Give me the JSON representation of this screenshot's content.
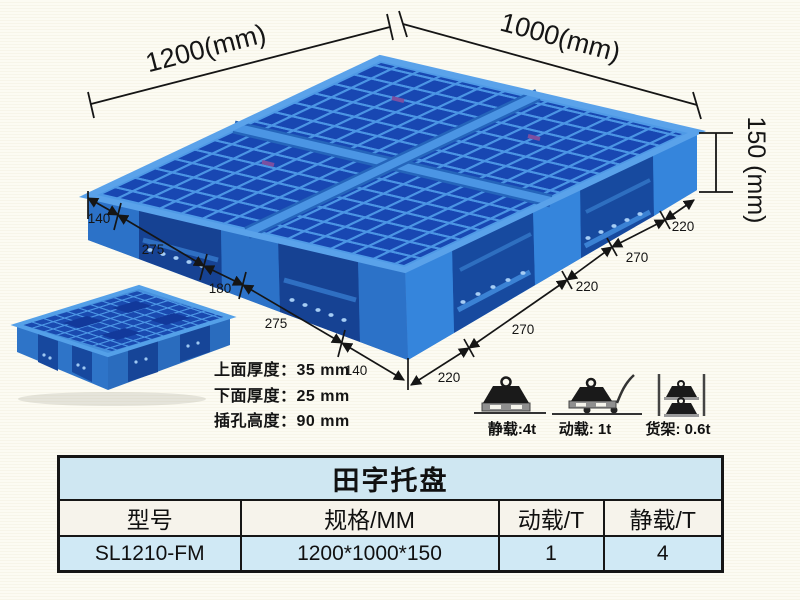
{
  "illustration": {
    "main_pallet": {
      "length_label": "1200(mm)",
      "width_label": "1000(mm)",
      "height_label": "150 (mm)",
      "bottom_left_segments": [
        "140",
        "275",
        "180",
        "275",
        "140"
      ],
      "bottom_right_segments": [
        "220",
        "270",
        "220",
        "270",
        "220"
      ]
    },
    "thickness_notes": {
      "top": "上面厚度：35 mm",
      "bottom": "下面厚度：25 mm",
      "fork_hole": "插孔高度：90 mm"
    },
    "load_ratings": {
      "static": "静载:4t",
      "dynamic": "动载: 1t",
      "rack": "货架: 0.6t"
    }
  },
  "spec_table": {
    "title": "田字托盘",
    "columns": [
      "型号",
      "规格/MM",
      "动载/T",
      "静载/T"
    ],
    "row": {
      "model": "SL1210-FM",
      "size": "1200*1000*150",
      "dynamic_load": "1",
      "static_load": "4"
    }
  },
  "colors": {
    "pallet_blue": "#2f7fd6",
    "pallet_dark_blue": "#1847b2",
    "pallet_light_blue": "#4b95e4",
    "background_cream": "#fbfaf0",
    "table_blue_row": "#cfe7f2",
    "table_header_row": "#f6f3eb",
    "dimension_ink": "#151515"
  }
}
